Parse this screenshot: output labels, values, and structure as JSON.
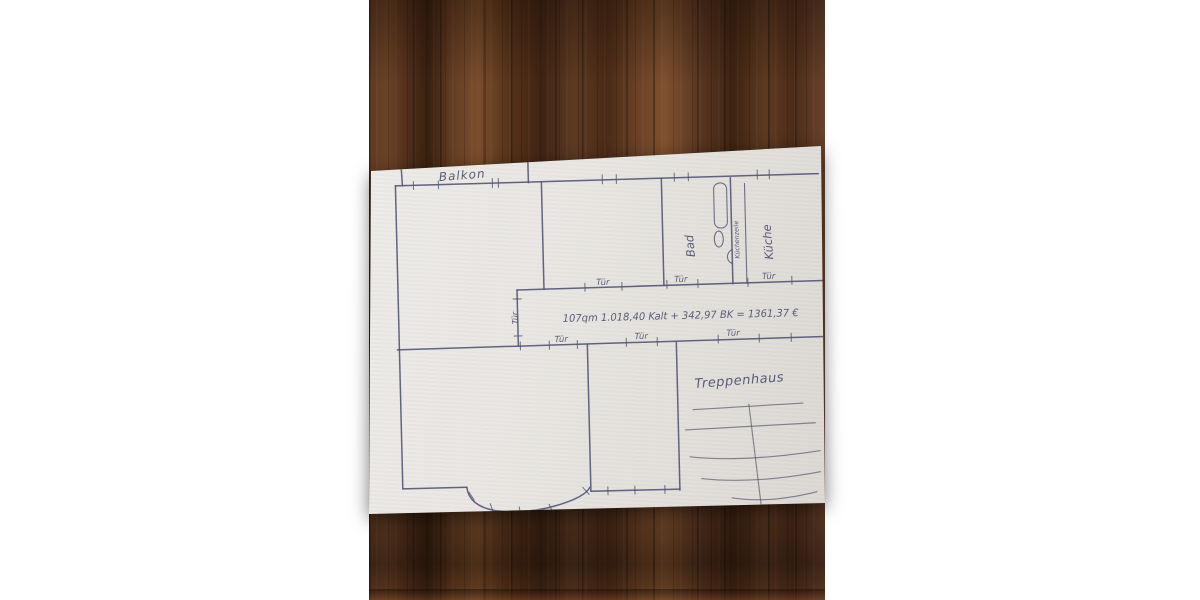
{
  "floor_plan": {
    "balcony_label": "Balkon",
    "bathroom_label": "Bad",
    "kitchenette_label": "Küchenzeile",
    "kitchen_label": "Küche",
    "stairwell_label": "Treppenhaus",
    "door_labels": [
      "Tür",
      "Tür",
      "Tür",
      "Tür",
      "Tür",
      "Tür",
      "Tür"
    ],
    "rent_note": "107qm   1.018,40 Kalt + 342,97 BK = 1361,37 €"
  },
  "theme": {
    "pen_color": "#4e516f",
    "paper_color": "#e9e6e2",
    "wood_dark": "#38200f",
    "wood_mid": "#5d3a22",
    "wood_light": "#7b4e2c",
    "margin_color": "#ffffff"
  }
}
